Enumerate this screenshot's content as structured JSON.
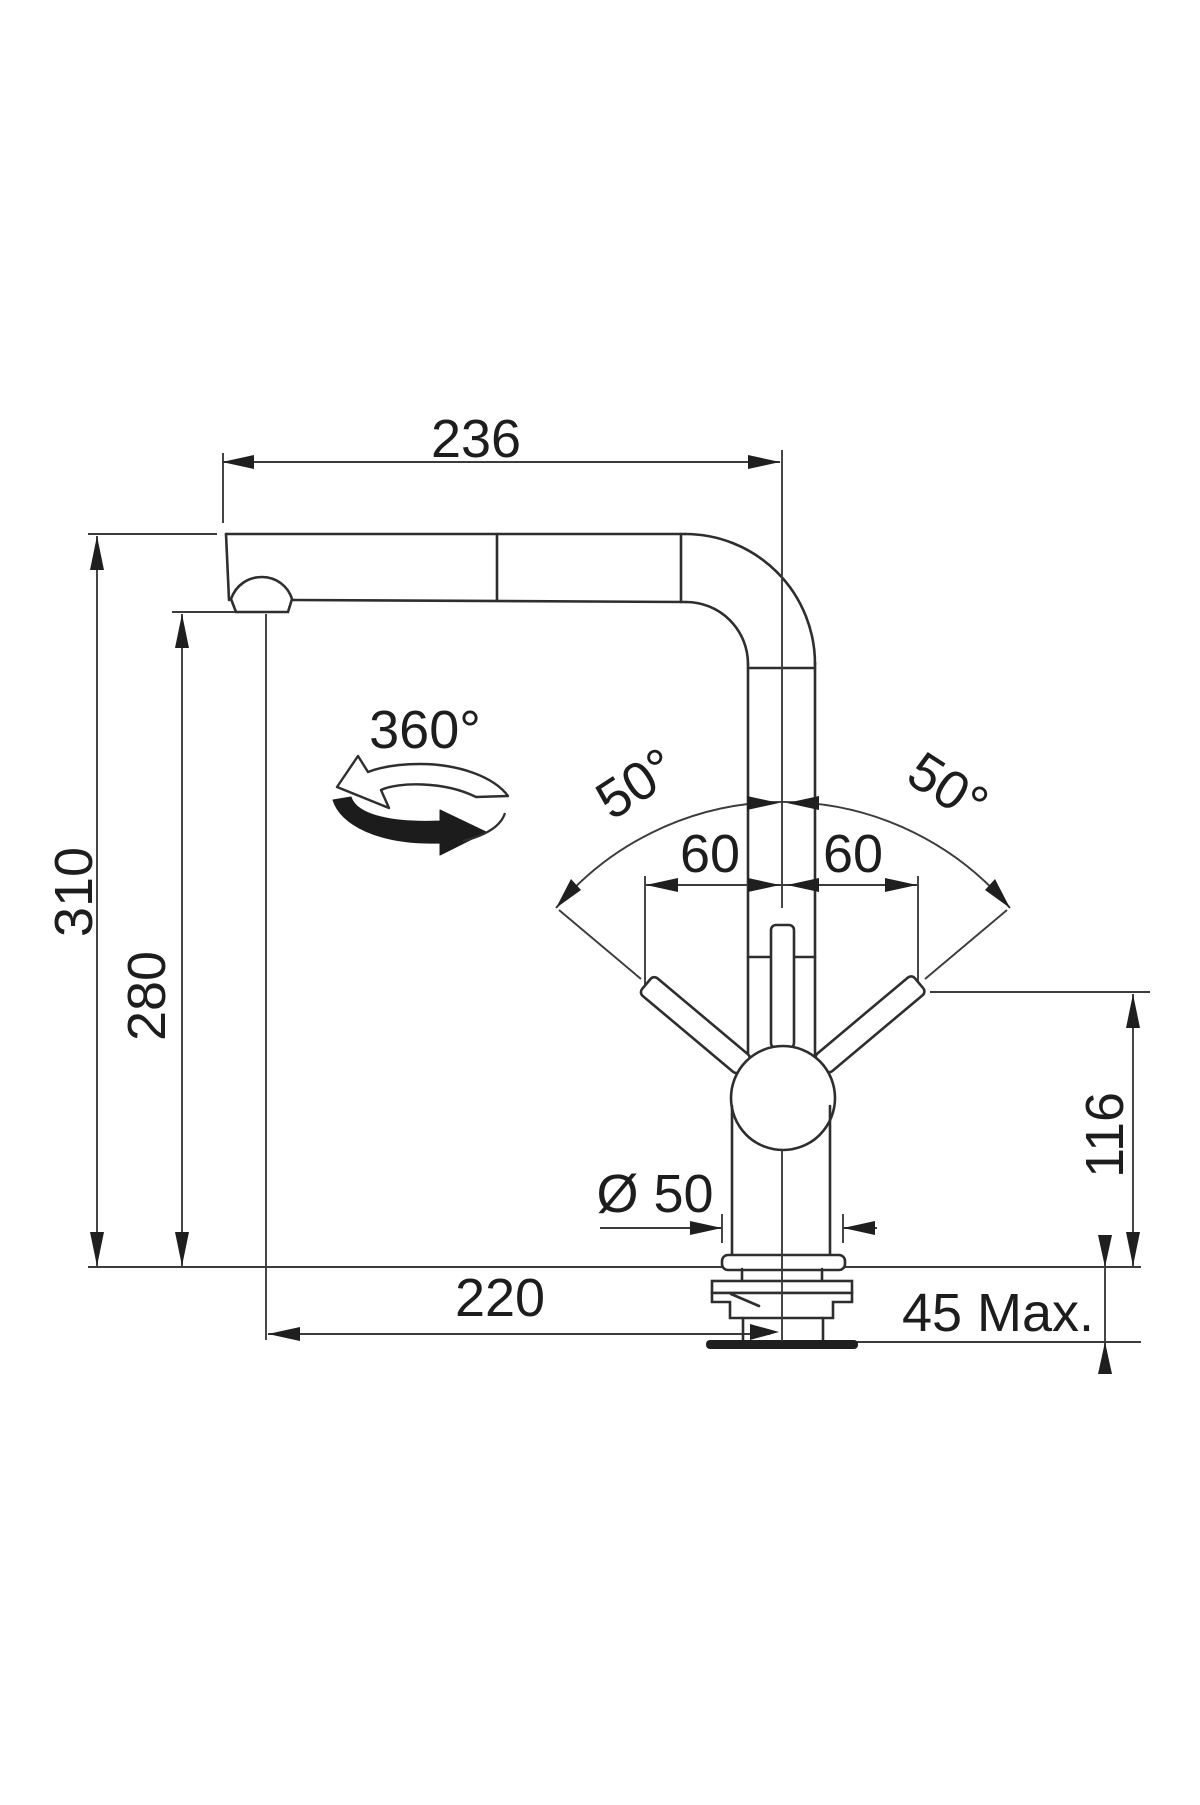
{
  "drawing": {
    "title": "Kitchen faucet dimensional drawing (pull-out spout)",
    "units": "mm",
    "ink_color": "#2e2e2e"
  },
  "labels": {
    "spout_reach": "236",
    "height_total": "310",
    "height_outlet": "280",
    "swivel_range": "360°",
    "lever_swing_left": "50°",
    "lever_swing_right": "50°",
    "lever_offset_left": "60",
    "lever_offset_right": "60",
    "lever_height": "116",
    "base_diameter": "Ø 50",
    "outlet_projection": "220",
    "deck_thickness": "45 Max."
  }
}
